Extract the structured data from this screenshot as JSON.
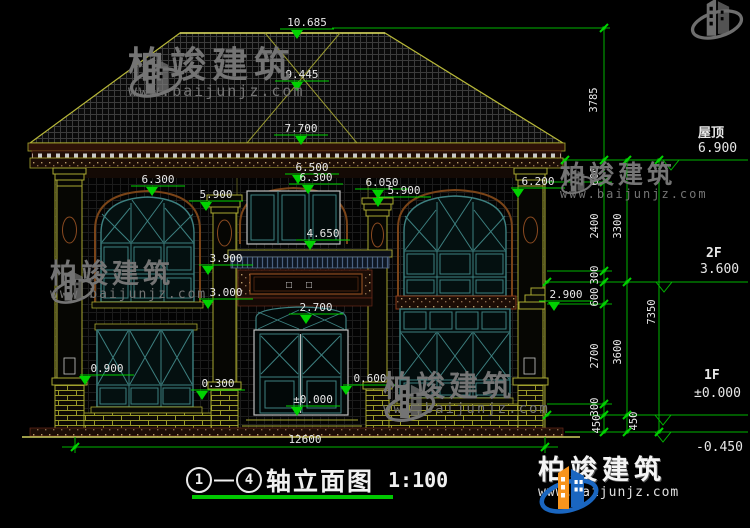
{
  "title": {
    "axis_start": "1",
    "axis_end": "4",
    "dash": "—",
    "name": "轴立面图",
    "scale": "1:100"
  },
  "brand": {
    "name": "柏竣建筑",
    "url": "www.baijunjz.com"
  },
  "right_elevations": {
    "roof_label": "屋顶",
    "roof_value": "6.900",
    "f2_label": "2F",
    "f2_value": "3.600",
    "f1_label": "1F",
    "f1_value": "±0.000",
    "ground_value": "-0.450"
  },
  "overall_width": "12600",
  "plaque_text": "□□",
  "elevation_markers": [
    {
      "text": "10.685",
      "x": 307,
      "y": 22,
      "tdx": -10
    },
    {
      "text": "9.445",
      "x": 302,
      "y": 74,
      "tdx": -5
    },
    {
      "text": "7.700",
      "x": 301,
      "y": 128,
      "tdx": 0
    },
    {
      "text": "6.300",
      "x": 158,
      "y": 179,
      "tdx": -6
    },
    {
      "text": "5.900",
      "x": 216,
      "y": 194,
      "tdx": -10
    },
    {
      "text": "6.500",
      "x": 312,
      "y": 167,
      "tdx": -14
    },
    {
      "text": "6.300",
      "x": 316,
      "y": 177,
      "tdx": -8
    },
    {
      "text": "6.050",
      "x": 382,
      "y": 182,
      "tdx": -4
    },
    {
      "text": "5.900",
      "x": 404,
      "y": 190,
      "tdx": -26
    },
    {
      "text": "6.200",
      "x": 538,
      "y": 181,
      "tdx": -20
    },
    {
      "text": "4.650",
      "x": 323,
      "y": 233,
      "tdx": -13
    },
    {
      "text": "3.900",
      "x": 226,
      "y": 258,
      "tdx": -18
    },
    {
      "text": "3.000",
      "x": 226,
      "y": 292,
      "tdx": -18
    },
    {
      "text": "2.900",
      "x": 566,
      "y": 294,
      "tdx": -12
    },
    {
      "text": "2.700",
      "x": 316,
      "y": 307,
      "tdx": -10
    },
    {
      "text": "0.900",
      "x": 107,
      "y": 368,
      "tdx": -22
    },
    {
      "text": "0.300",
      "x": 218,
      "y": 383,
      "tdx": -16
    },
    {
      "text": "0.600",
      "x": 370,
      "y": 378,
      "tdx": -24
    },
    {
      "text": "±0.000",
      "x": 313,
      "y": 399,
      "tdx": -16
    }
  ],
  "vertical_dims": [
    {
      "text": "3785",
      "x": 597,
      "y": 100
    },
    {
      "text": "600",
      "x": 598,
      "y": 176
    },
    {
      "text": "2400",
      "x": 598,
      "y": 226
    },
    {
      "text": "300",
      "x": 598,
      "y": 275
    },
    {
      "text": "600",
      "x": 598,
      "y": 297
    },
    {
      "text": "2700",
      "x": 598,
      "y": 356
    },
    {
      "text": "300",
      "x": 598,
      "y": 407
    },
    {
      "text": "450",
      "x": 600,
      "y": 424
    },
    {
      "text": "3300",
      "x": 621,
      "y": 226
    },
    {
      "text": "3600",
      "x": 621,
      "y": 352
    },
    {
      "text": "450",
      "x": 637,
      "y": 421
    },
    {
      "text": "7350",
      "x": 655,
      "y": 312
    }
  ],
  "horizontal_dims": [
    {
      "text": "12600",
      "x": 305,
      "y": 443
    }
  ],
  "colors": {
    "bg": "#000000",
    "dim_green": "#00c800",
    "text_white": "#e8e8e8",
    "outline_olive": "#b8b838",
    "frame_teal": "#3d8080",
    "band_maroon": "#6a2a1a",
    "logo_blue": "#1a66c0",
    "logo_orange": "#f7941d"
  }
}
